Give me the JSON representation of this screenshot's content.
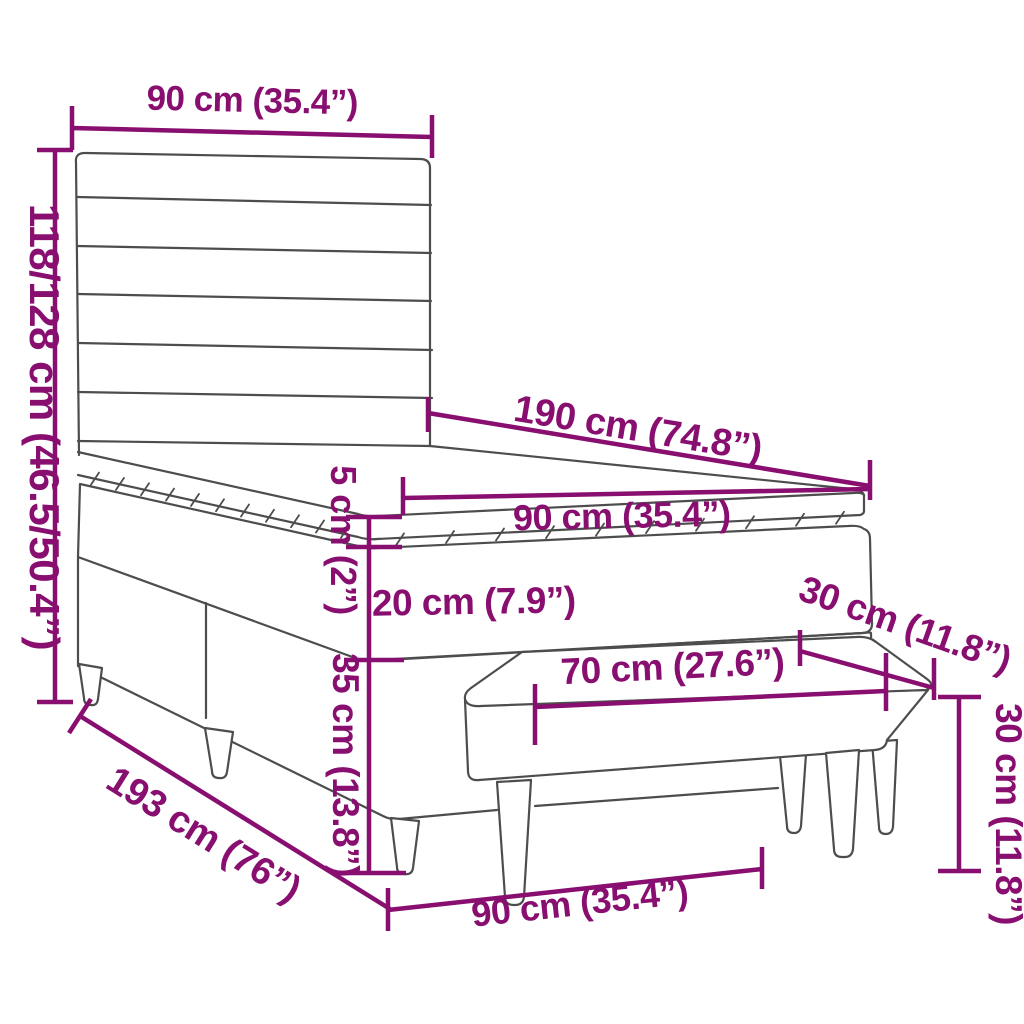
{
  "diagram": {
    "type": "product-dimension-diagram",
    "product_parts": [
      "headboard",
      "mattress-topper",
      "mattress",
      "box-spring-base",
      "bed-legs",
      "bench"
    ],
    "style": {
      "accent_color": "#880E70",
      "line_color": "#4D4D4D",
      "background": "#FFFFFF"
    },
    "labels": {
      "headboard_width": "90 cm (35.4”)",
      "headboard_height": "118/128 cm (46.5/50.4”)",
      "bed_length": "190 cm (74.8”)",
      "topper_height": "5 cm (2”)",
      "bed_width": "90 cm (35.4”)",
      "mattress_height": "20 cm (7.9”)",
      "base_height": "35 cm (13.8”)",
      "frame_length": "193 cm (76”)",
      "bench_seat_length": "70 cm (27.6”)",
      "bench_depth": "30 cm (11.8”)",
      "bench_height": "30 cm (11.8”)",
      "bench_total_length": "90 cm (35.4”)"
    }
  }
}
